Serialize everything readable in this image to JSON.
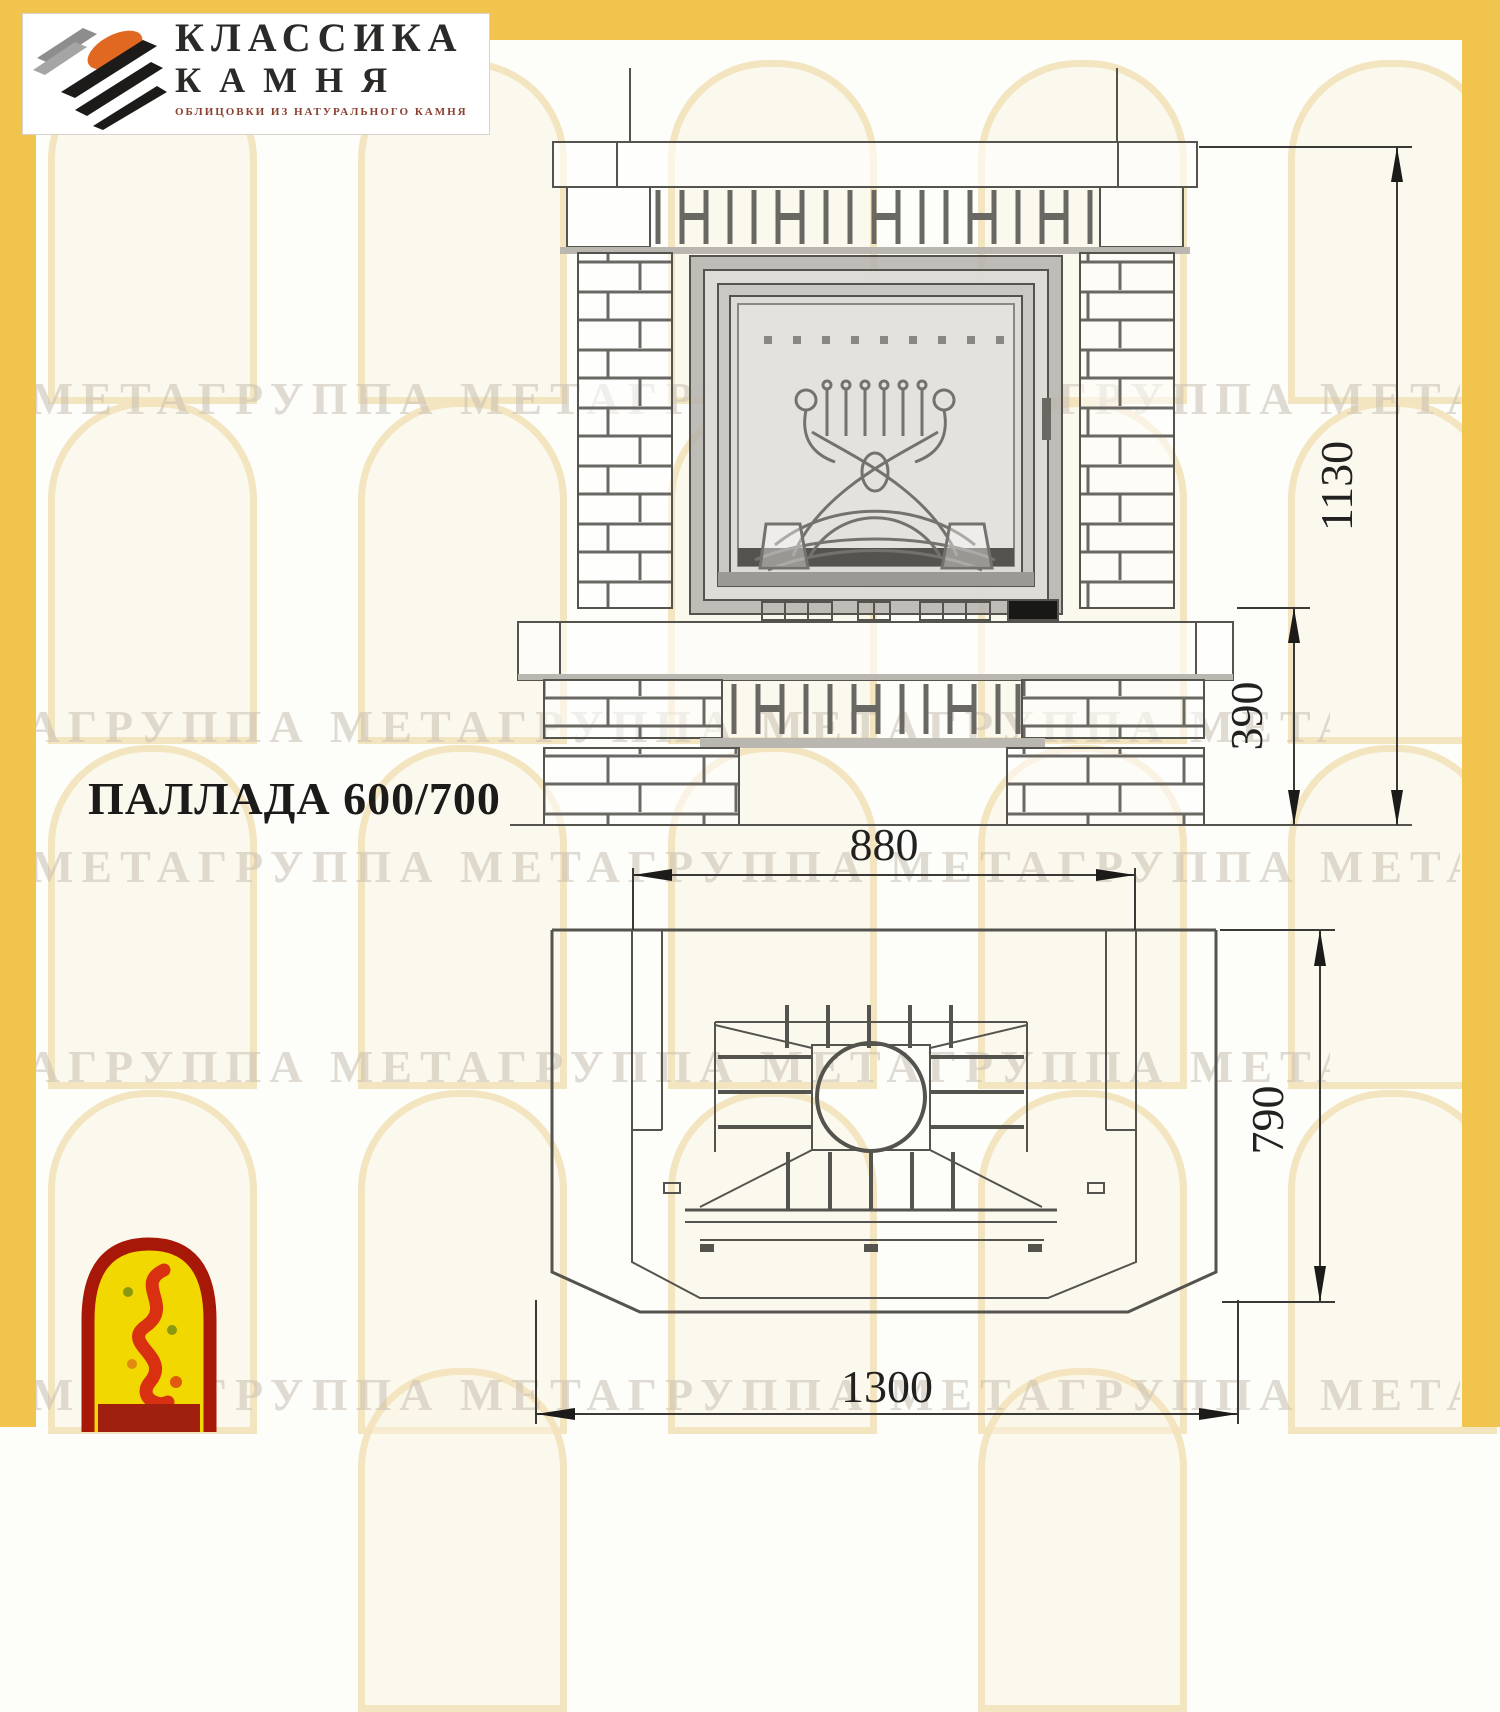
{
  "brand": {
    "line1": "КЛАССИКА",
    "line2": "КАМНЯ",
    "tagline": "ОБЛИЦОВКИ ИЗ НАТУРАЛЬНОГО КАМНЯ"
  },
  "title": "ПАЛЛАДА 600/700",
  "watermark": {
    "text": "МЕТАГРУППА МЕТАГРУППА МЕТАГРУППА МЕТА"
  },
  "front_elevation": {
    "dim_total_height": "1130",
    "dim_base_height": "390"
  },
  "plan_view": {
    "dim_opening_width": "880",
    "dim_depth": "790",
    "dim_total_width": "1300"
  },
  "colors": {
    "frame_yellow": "#f1c54d",
    "drawing_line": "#55534e",
    "dimension_text": "#22211f",
    "logo_orange": "#e06820",
    "arch_logo_red": "#a81808",
    "arch_logo_yellow": "#f0d800"
  }
}
